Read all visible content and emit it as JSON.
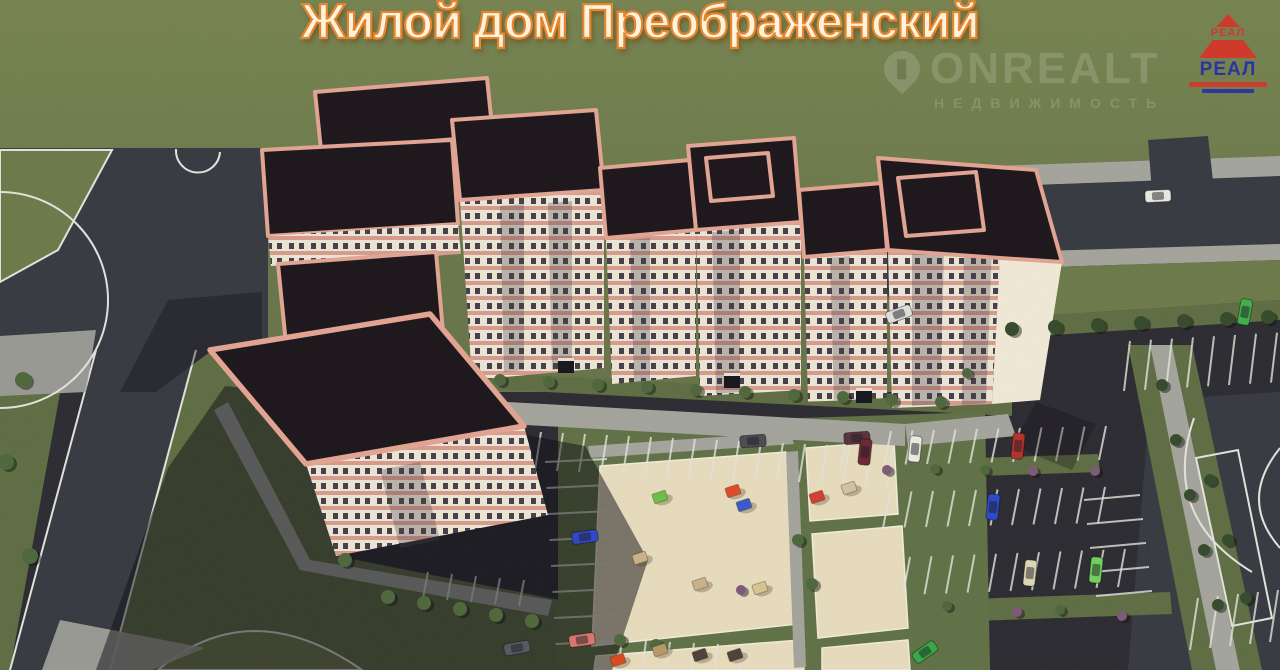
{
  "title": "Жилой дом Преображенский",
  "watermark": {
    "brand": "ONREALT",
    "tagline": "НЕДВИЖИМОСТЬ"
  },
  "logo": {
    "top_text": "РЕАЛ",
    "main_text": "РЕАЛ"
  },
  "colors": {
    "grass": "#6b7949",
    "grass_dark": "#5d6c42",
    "asphalt": "#35383f",
    "asphalt_dark": "#2a2930",
    "sidewalk": "#a3a39c",
    "sand": "#e7dbbd",
    "roof": "#1a141a",
    "trim": "#e3a392",
    "facade": "#ece5d5",
    "facade_stripe": "#d89a8c",
    "window": "#453c47",
    "tree": "#4c663a",
    "tree_dark": "#33492a",
    "bush_purple": "#7b5878",
    "shadow": "#0c0911",
    "line_white": "#e3e3dc",
    "title_fill": "#fff3dd",
    "title_outline": "#e3862f",
    "logo_red": "#cf3a2d",
    "logo_blue": "#2a35a0",
    "watermark": "#ffffff"
  },
  "scene": {
    "cars": [
      {
        "x": 1158,
        "y": 196,
        "color": "#e9e9e3",
        "angle": -3
      },
      {
        "x": 899,
        "y": 314,
        "color": "#dfe0da",
        "angle": -20
      },
      {
        "x": 1245,
        "y": 312,
        "color": "#3fae4a",
        "angle": -80
      },
      {
        "x": 753,
        "y": 441,
        "color": "#4a4a52",
        "angle": -4
      },
      {
        "x": 857,
        "y": 438,
        "color": "#5a3038",
        "angle": -4
      },
      {
        "x": 865,
        "y": 452,
        "color": "#6b2430",
        "angle": -84
      },
      {
        "x": 915,
        "y": 449,
        "color": "#eceae2",
        "angle": -84
      },
      {
        "x": 1018,
        "y": 446,
        "color": "#b23028",
        "angle": -84
      },
      {
        "x": 993,
        "y": 507,
        "color": "#2847c8",
        "angle": -84
      },
      {
        "x": 1030,
        "y": 573,
        "color": "#ded8b4",
        "angle": -84
      },
      {
        "x": 1096,
        "y": 570,
        "color": "#6fd05c",
        "angle": -84
      },
      {
        "x": 925,
        "y": 652,
        "color": "#35a845",
        "angle": -35
      },
      {
        "x": 585,
        "y": 537,
        "color": "#2f44c4",
        "angle": -8
      },
      {
        "x": 582,
        "y": 640,
        "color": "#d8746a",
        "angle": -8
      },
      {
        "x": 517,
        "y": 648,
        "color": "#56565e",
        "angle": -10
      }
    ],
    "greenery": [
      {
        "x": 500,
        "y": 380,
        "r": 6,
        "kind": "tree"
      },
      {
        "x": 549,
        "y": 382,
        "r": 6,
        "kind": "tree"
      },
      {
        "x": 598,
        "y": 385,
        "r": 6,
        "kind": "tree"
      },
      {
        "x": 647,
        "y": 387,
        "r": 6,
        "kind": "tree"
      },
      {
        "x": 696,
        "y": 390,
        "r": 6,
        "kind": "tree"
      },
      {
        "x": 745,
        "y": 392,
        "r": 6,
        "kind": "tree"
      },
      {
        "x": 794,
        "y": 395,
        "r": 6,
        "kind": "tree"
      },
      {
        "x": 843,
        "y": 397,
        "r": 6,
        "kind": "tree"
      },
      {
        "x": 892,
        "y": 400,
        "r": 6,
        "kind": "tree"
      },
      {
        "x": 941,
        "y": 402,
        "r": 6,
        "kind": "tree"
      },
      {
        "x": 967,
        "y": 373,
        "r": 5,
        "kind": "tree"
      },
      {
        "x": 1012,
        "y": 329,
        "r": 7,
        "kind": "tree-dark"
      },
      {
        "x": 1055,
        "y": 327,
        "r": 7,
        "kind": "tree-dark"
      },
      {
        "x": 1098,
        "y": 325,
        "r": 7,
        "kind": "tree-dark"
      },
      {
        "x": 1141,
        "y": 323,
        "r": 7,
        "kind": "tree-dark"
      },
      {
        "x": 1184,
        "y": 321,
        "r": 7,
        "kind": "tree-dark"
      },
      {
        "x": 1227,
        "y": 319,
        "r": 7,
        "kind": "tree-dark"
      },
      {
        "x": 1268,
        "y": 317,
        "r": 7,
        "kind": "tree-dark"
      },
      {
        "x": 1162,
        "y": 385,
        "r": 6,
        "kind": "tree-dark"
      },
      {
        "x": 1176,
        "y": 440,
        "r": 6,
        "kind": "tree-dark"
      },
      {
        "x": 1190,
        "y": 495,
        "r": 6,
        "kind": "tree-dark"
      },
      {
        "x": 1204,
        "y": 550,
        "r": 6,
        "kind": "tree-dark"
      },
      {
        "x": 1218,
        "y": 605,
        "r": 6,
        "kind": "tree-dark"
      },
      {
        "x": 1210,
        "y": 480,
        "r": 6,
        "kind": "tree-dark"
      },
      {
        "x": 1228,
        "y": 540,
        "r": 6,
        "kind": "tree-dark"
      },
      {
        "x": 1246,
        "y": 598,
        "r": 6,
        "kind": "tree-dark"
      },
      {
        "x": 887,
        "y": 470,
        "r": 5,
        "kind": "bush-purple"
      },
      {
        "x": 1033,
        "y": 471,
        "r": 5,
        "kind": "bush-purple"
      },
      {
        "x": 1095,
        "y": 471,
        "r": 5,
        "kind": "bush-purple"
      },
      {
        "x": 935,
        "y": 469,
        "r": 5,
        "kind": "tree"
      },
      {
        "x": 985,
        "y": 470,
        "r": 5,
        "kind": "tree"
      },
      {
        "x": 1017,
        "y": 612,
        "r": 5,
        "kind": "bush-purple"
      },
      {
        "x": 1122,
        "y": 616,
        "r": 5,
        "kind": "bush-purple"
      },
      {
        "x": 947,
        "y": 606,
        "r": 5,
        "kind": "tree"
      },
      {
        "x": 1060,
        "y": 610,
        "r": 5,
        "kind": "tree"
      },
      {
        "x": 388,
        "y": 597,
        "r": 7,
        "kind": "tree"
      },
      {
        "x": 424,
        "y": 603,
        "r": 7,
        "kind": "tree"
      },
      {
        "x": 460,
        "y": 609,
        "r": 7,
        "kind": "tree"
      },
      {
        "x": 496,
        "y": 615,
        "r": 7,
        "kind": "tree"
      },
      {
        "x": 532,
        "y": 621,
        "r": 7,
        "kind": "tree"
      },
      {
        "x": 345,
        "y": 560,
        "r": 7,
        "kind": "tree"
      },
      {
        "x": 620,
        "y": 640,
        "r": 6,
        "kind": "tree"
      },
      {
        "x": 656,
        "y": 645,
        "r": 6,
        "kind": "tree"
      },
      {
        "x": 23,
        "y": 380,
        "r": 8,
        "kind": "tree"
      },
      {
        "x": 6,
        "y": 462,
        "r": 8,
        "kind": "tree"
      },
      {
        "x": 30,
        "y": 556,
        "r": 8,
        "kind": "tree"
      },
      {
        "x": 741,
        "y": 590,
        "r": 5,
        "kind": "bush-purple"
      },
      {
        "x": 798,
        "y": 540,
        "r": 6,
        "kind": "tree"
      },
      {
        "x": 812,
        "y": 584,
        "r": 6,
        "kind": "tree"
      }
    ],
    "play_equipment": [
      {
        "x": 660,
        "y": 497,
        "color": "#6abf45",
        "label": "slide"
      },
      {
        "x": 733,
        "y": 491,
        "color": "#e04828",
        "label": "climbing-frame"
      },
      {
        "x": 744,
        "y": 505,
        "color": "#3858c8",
        "label": "climbing-frame"
      },
      {
        "x": 817,
        "y": 497,
        "color": "#d43c30",
        "label": "spring-rider"
      },
      {
        "x": 849,
        "y": 488,
        "color": "#cfc4a0",
        "label": "swing"
      },
      {
        "x": 640,
        "y": 558,
        "color": "#c9b089",
        "label": "sandbox"
      },
      {
        "x": 700,
        "y": 584,
        "color": "#c9b089",
        "label": "bench"
      },
      {
        "x": 760,
        "y": 588,
        "color": "#d8c48e",
        "label": "pergola"
      },
      {
        "x": 660,
        "y": 650,
        "color": "#b59a6a",
        "label": "climbing-frame"
      },
      {
        "x": 700,
        "y": 655,
        "color": "#4a4038",
        "label": "carousel"
      },
      {
        "x": 735,
        "y": 655,
        "color": "#4a4038",
        "label": "carousel"
      },
      {
        "x": 618,
        "y": 660,
        "color": "#d84820",
        "label": "play-structure"
      }
    ]
  }
}
